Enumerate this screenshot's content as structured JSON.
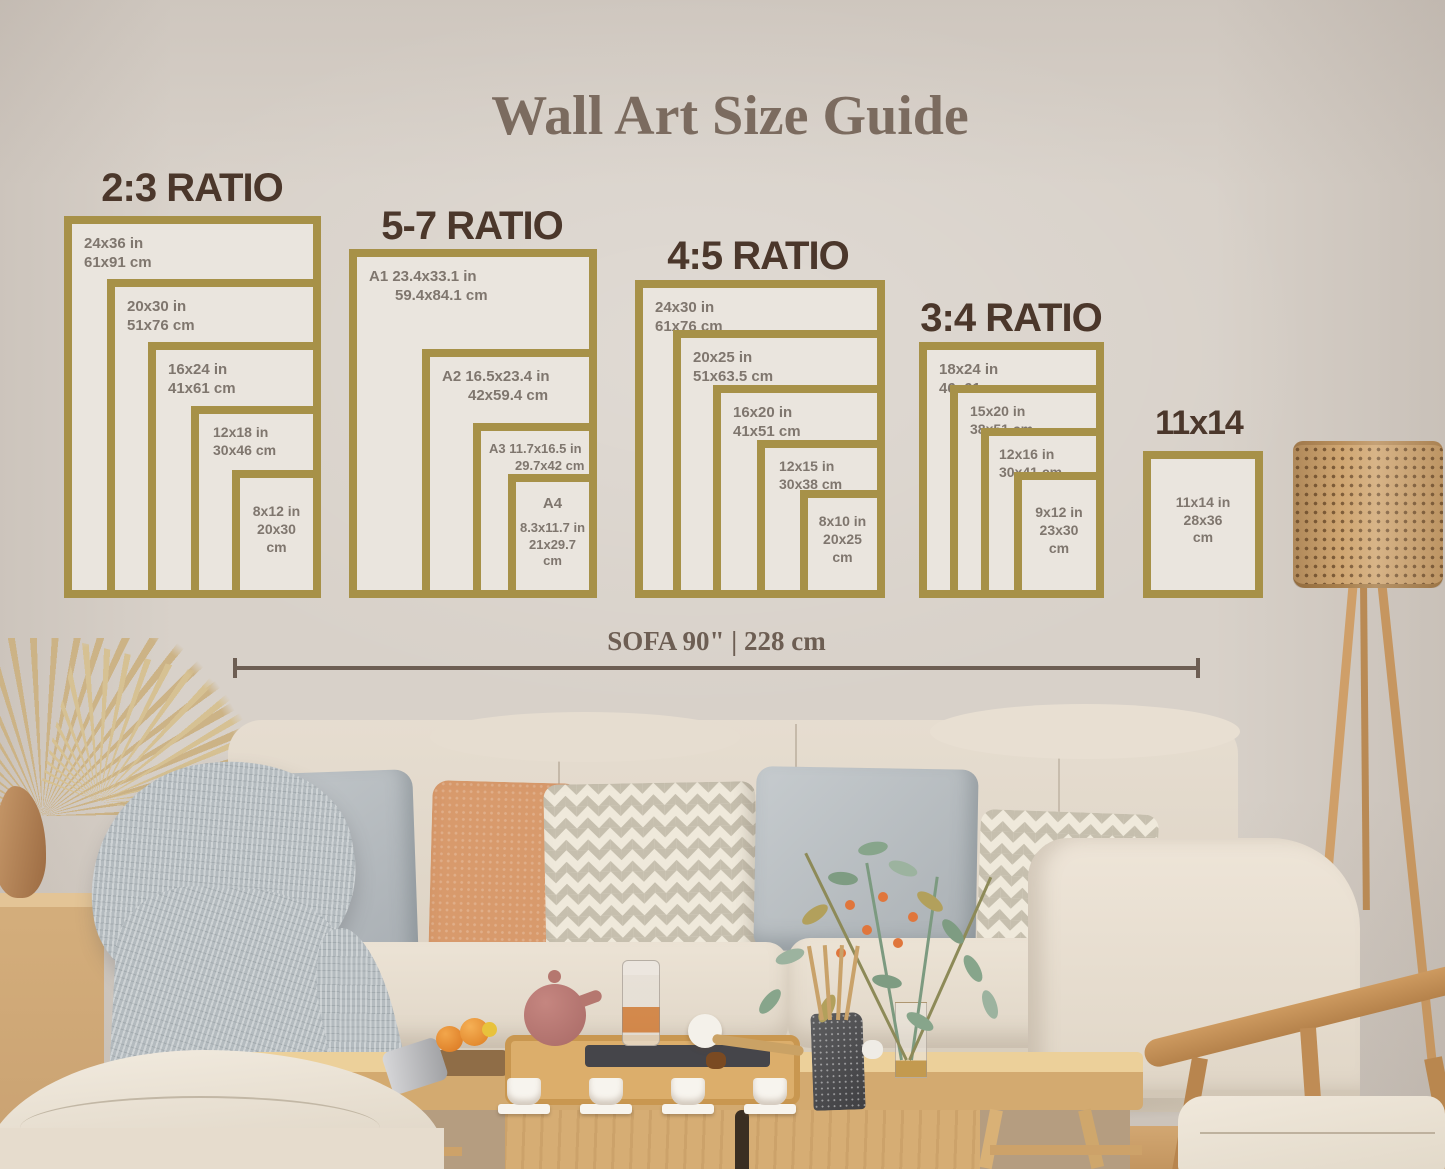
{
  "title": "Wall Art Size Guide",
  "ratio_groups": [
    {
      "heading": "2:3 RATIO",
      "frames": [
        {
          "size_in": "24x36 in",
          "size_cm": "61x91 cm"
        },
        {
          "size_in": "20x30 in",
          "size_cm": "51x76 cm"
        },
        {
          "size_in": "16x24 in",
          "size_cm": "41x61 cm"
        },
        {
          "size_in": "12x18 in",
          "size_cm": "30x46 cm"
        },
        {
          "size_in": "8x12 in",
          "size_cm": "20x30 cm"
        }
      ]
    },
    {
      "heading": "5-7 RATIO",
      "frames": [
        {
          "size_in": "A1 23.4x33.1 in",
          "size_cm": "59.4x84.1 cm"
        },
        {
          "size_in": "A2 16.5x23.4 in",
          "size_cm": "42x59.4 cm"
        },
        {
          "size_in": "A3 11.7x16.5 in",
          "size_cm": "29.7x42 cm"
        },
        {
          "prefix": "A4",
          "size_in": "8.3x11.7 in",
          "size_cm": "21x29.7 cm"
        }
      ]
    },
    {
      "heading": "4:5 RATIO",
      "frames": [
        {
          "size_in": "24x30 in",
          "size_cm": "61x76 cm"
        },
        {
          "size_in": "20x25 in",
          "size_cm": "51x63.5 cm"
        },
        {
          "size_in": "16x20 in",
          "size_cm": "41x51 cm"
        },
        {
          "size_in": "12x15 in",
          "size_cm": "30x38 cm"
        },
        {
          "size_in": "8x10 in",
          "size_cm": "20x25 cm"
        }
      ]
    },
    {
      "heading": "3:4 RATIO",
      "frames": [
        {
          "size_in": "18x24 in",
          "size_cm": "46x61 cm"
        },
        {
          "size_in": "15x20 in",
          "size_cm": "38x51 cm"
        },
        {
          "size_in": "12x16 in",
          "size_cm": "30x41 cm"
        },
        {
          "size_in": "9x12 in",
          "size_cm": "23x30 cm"
        }
      ]
    },
    {
      "heading": "11x14",
      "frames": [
        {
          "size_in": "11x14 in",
          "size_cm": "28x36 cm"
        }
      ]
    }
  ],
  "sofa_measurement": {
    "label": "SOFA 90\" | 228 cm"
  },
  "colors": {
    "wall": "#d8d1c9",
    "frame_border": "#a79148",
    "frame_fill": "#eae5de",
    "heading": "#4b372b",
    "label": "#7f766e",
    "title": "#7b6b5f",
    "measure": "#6d5e53"
  }
}
